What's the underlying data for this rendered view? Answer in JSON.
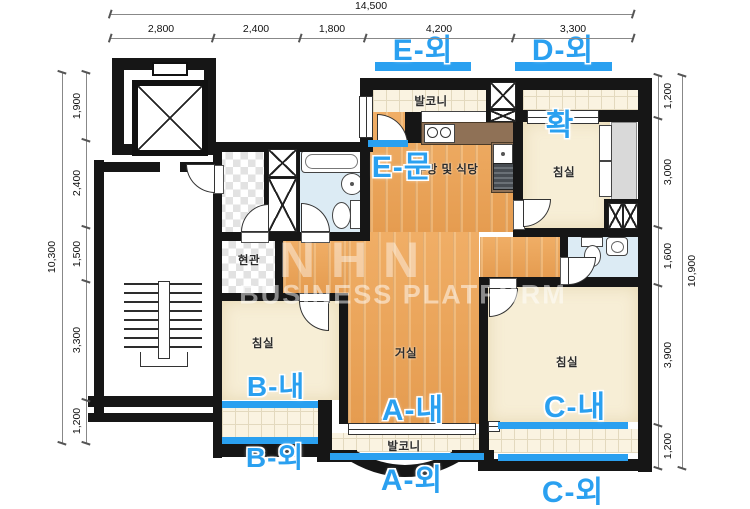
{
  "colors": {
    "highlight": "#2aa0f0",
    "wall": "#161616",
    "wood_floor": "#eba75f",
    "bedroom_floor": "#f7eed6",
    "balcony_tile": "#faf3e1",
    "bath_floor": "#dcebf4",
    "counter": "#8f7156"
  },
  "dimensions": {
    "top": {
      "total": "14,500",
      "segments": [
        "2,800",
        "2,400",
        "1,800",
        "4,200",
        "3,300"
      ]
    },
    "left": {
      "total": "10,300",
      "segments": [
        "1,900",
        "2,400",
        "1,500",
        "3,300",
        "1,200"
      ]
    },
    "right": {
      "total": "10,900",
      "segments": [
        "1,200",
        "3,000",
        "1,600",
        "3,900",
        "1,200"
      ]
    }
  },
  "rooms": {
    "balcony_top": "발코니",
    "kitchen": "주방 및 식당",
    "bedroom_top_right": "침실",
    "entrance": "현관",
    "bedroom_left": "침실",
    "living": "거실",
    "bedroom_right": "침실",
    "balcony_bottom": "발코니"
  },
  "annotations": {
    "e_out": "E-외",
    "d_out": "D-외",
    "e_door": "E-문",
    "hwak": "확",
    "b_in": "B-내",
    "a_in": "A-내",
    "c_in": "C-내",
    "b_out": "B-외",
    "a_out": "A-외",
    "c_out": "C-외"
  },
  "watermark": {
    "logo": "NHN",
    "text": "BUSINESS PLATFORM"
  }
}
